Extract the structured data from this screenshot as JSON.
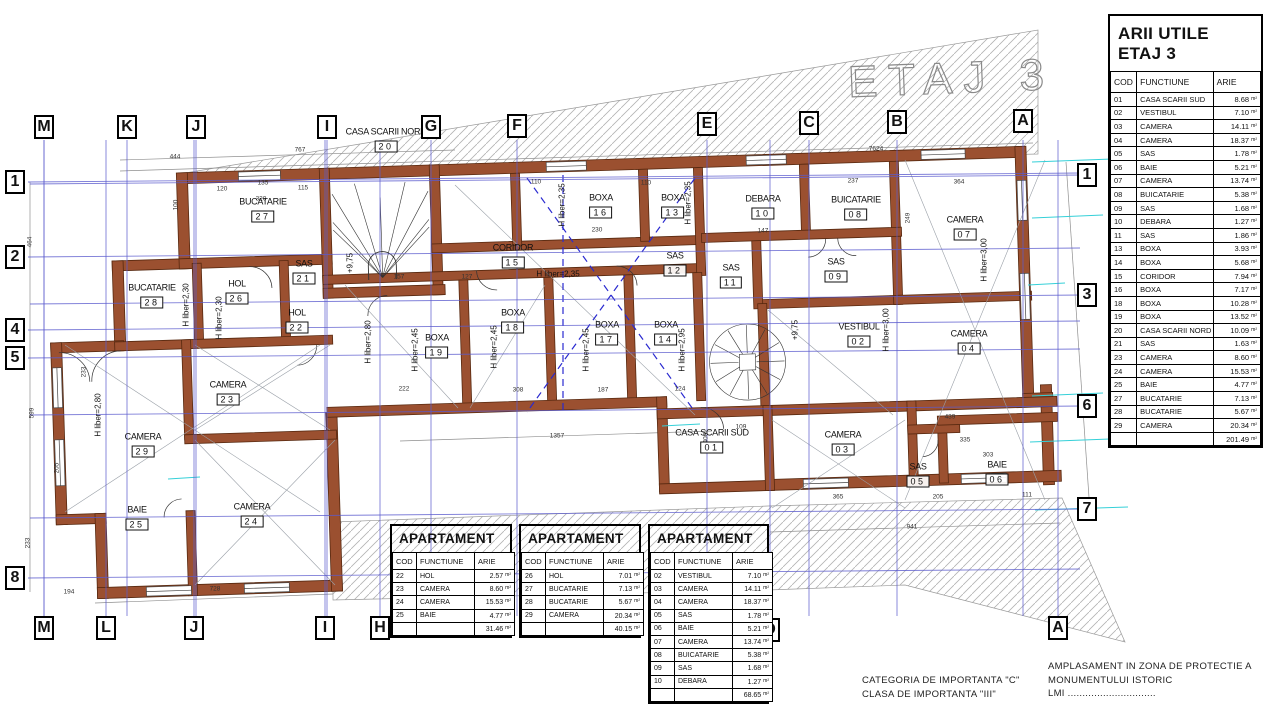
{
  "watermark": "ETAJ 3",
  "unit": "m²",
  "table_cols": [
    "COD",
    "FUNCTIUNE",
    "ARIE"
  ],
  "arii": {
    "title_line1": "ARII UTILE",
    "title_line2": "ETAJ 3",
    "rows": [
      [
        "01",
        "CASA SCARII SUD",
        "8.68"
      ],
      [
        "02",
        "VESTIBUL",
        "7.10"
      ],
      [
        "03",
        "CAMERA",
        "14.11"
      ],
      [
        "04",
        "CAMERA",
        "18.37"
      ],
      [
        "05",
        "SAS",
        "1.78"
      ],
      [
        "06",
        "BAIE",
        "5.21"
      ],
      [
        "07",
        "CAMERA",
        "13.74"
      ],
      [
        "08",
        "BUICATARIE",
        "5.38"
      ],
      [
        "09",
        "SAS",
        "1.68"
      ],
      [
        "10",
        "DEBARA",
        "1.27"
      ],
      [
        "11",
        "SAS",
        "1.86"
      ],
      [
        "13",
        "BOXA",
        "3.93"
      ],
      [
        "14",
        "BOXA",
        "5.68"
      ],
      [
        "15",
        "CORIDOR",
        "7.94"
      ],
      [
        "16",
        "BOXA",
        "7.17"
      ],
      [
        "18",
        "BOXA",
        "10.28"
      ],
      [
        "19",
        "BOXA",
        "13.52"
      ],
      [
        "20",
        "CASA SCARII NORD",
        "10.09"
      ],
      [
        "21",
        "SAS",
        "1.63"
      ],
      [
        "23",
        "CAMERA",
        "8.60"
      ],
      [
        "24",
        "CAMERA",
        "15.53"
      ],
      [
        "25",
        "BAIE",
        "4.77"
      ],
      [
        "27",
        "BUCATARIE",
        "7.13"
      ],
      [
        "28",
        "BUCATARIE",
        "5.67"
      ],
      [
        "29",
        "CAMERA",
        "20.34"
      ]
    ],
    "total": "201.49"
  },
  "apartments": [
    {
      "title_line1": "APARTAMENT",
      "title_line2": "NORD 1",
      "x": 390,
      "y": 524,
      "w": 122,
      "rows": [
        [
          "22",
          "HOL",
          "2.57"
        ],
        [
          "23",
          "CAMERA",
          "8.60"
        ],
        [
          "24",
          "CAMERA",
          "15.53"
        ],
        [
          "25",
          "BAIE",
          "4.77"
        ]
      ],
      "total": "31.46"
    },
    {
      "title_line1": "APARTAMENT",
      "title_line2": "NORD 2",
      "x": 519,
      "y": 524,
      "w": 122,
      "rows": [
        [
          "26",
          "HOL",
          "7.01"
        ],
        [
          "27",
          "BUCATARIE",
          "7.13"
        ],
        [
          "28",
          "BUCATARIE",
          "5.67"
        ],
        [
          "29",
          "CAMERA",
          "20.34"
        ]
      ],
      "total": "40.15"
    },
    {
      "title_line1": "APARTAMENT",
      "title_line2": "SUD",
      "x": 648,
      "y": 524,
      "w": 121,
      "rows": [
        [
          "02",
          "VESTIBUL",
          "7.10"
        ],
        [
          "03",
          "CAMERA",
          "14.11"
        ],
        [
          "04",
          "CAMERA",
          "18.37"
        ],
        [
          "05",
          "SAS",
          "1.78"
        ],
        [
          "06",
          "BAIE",
          "5.21"
        ],
        [
          "07",
          "CAMERA",
          "13.74"
        ],
        [
          "08",
          "BUICATARIE",
          "5.38"
        ],
        [
          "09",
          "SAS",
          "1.68"
        ],
        [
          "10",
          "DEBARA",
          "1.27"
        ]
      ],
      "total": "68.65"
    }
  ],
  "footer": {
    "categoria_line1": "CATEGORIA  DE  IMPORTANTA    \"C\"",
    "categoria_line2": "CLASA  DE  IMPORTANTA    \"III\"",
    "amplasament_line1": "AMPLASAMENT  IN  ZONA  DE  PROTECTIE  A",
    "amplasament_line2": "MONUMENTULUI  ISTORIC",
    "amplasament_line3": "LMI  .............................."
  },
  "axes": {
    "top": [
      {
        "l": "M",
        "x": 44,
        "y": 127
      },
      {
        "l": "K",
        "x": 127,
        "y": 127
      },
      {
        "l": "J",
        "x": 196,
        "y": 127
      },
      {
        "l": "I",
        "x": 327,
        "y": 127
      },
      {
        "l": "G",
        "x": 431,
        "y": 127
      },
      {
        "l": "F",
        "x": 517,
        "y": 126
      },
      {
        "l": "E",
        "x": 707,
        "y": 124
      },
      {
        "l": "C",
        "x": 809,
        "y": 123
      },
      {
        "l": "B",
        "x": 897,
        "y": 122
      },
      {
        "l": "A",
        "x": 1023,
        "y": 121
      }
    ],
    "bottom": [
      {
        "l": "M",
        "x": 44,
        "y": 628
      },
      {
        "l": "L",
        "x": 106,
        "y": 628
      },
      {
        "l": "J",
        "x": 194,
        "y": 628
      },
      {
        "l": "I",
        "x": 325,
        "y": 628
      },
      {
        "l": "H",
        "x": 380,
        "y": 628
      },
      {
        "l": "D",
        "x": 770,
        "y": 630
      },
      {
        "l": "A",
        "x": 1058,
        "y": 628
      }
    ],
    "left": [
      {
        "l": "1",
        "x": 15,
        "y": 182
      },
      {
        "l": "2",
        "x": 15,
        "y": 257
      },
      {
        "l": "4",
        "x": 15,
        "y": 330
      },
      {
        "l": "5",
        "x": 15,
        "y": 358
      },
      {
        "l": "8",
        "x": 15,
        "y": 578
      }
    ],
    "right": [
      {
        "l": "1",
        "x": 1087,
        "y": 175
      },
      {
        "l": "3",
        "x": 1087,
        "y": 295
      },
      {
        "l": "6",
        "x": 1087,
        "y": 406
      },
      {
        "l": "7",
        "x": 1087,
        "y": 509
      }
    ]
  },
  "rooms": [
    {
      "name": "CASA SCARII NORD",
      "code": "20",
      "x": 386,
      "y": 141
    },
    {
      "name": "BUCATARIE",
      "code": "27",
      "x": 263,
      "y": 211
    },
    {
      "name": "BUCATARIE",
      "code": "28",
      "x": 152,
      "y": 297
    },
    {
      "name": "HOL",
      "code": "26",
      "x": 237,
      "y": 293
    },
    {
      "name": "SAS",
      "code": "21",
      "x": 304,
      "y": 273
    },
    {
      "name": "HOL",
      "code": "22",
      "x": 297,
      "y": 322
    },
    {
      "name": "CAMERA",
      "code": "23",
      "x": 228,
      "y": 394
    },
    {
      "name": "CAMERA",
      "code": "29",
      "x": 143,
      "y": 446
    },
    {
      "name": "CAMERA",
      "code": "24",
      "x": 252,
      "y": 516
    },
    {
      "name": "BAIE",
      "code": "25",
      "x": 137,
      "y": 519
    },
    {
      "name": "BOXA",
      "code": "19",
      "x": 437,
      "y": 347
    },
    {
      "name": "BOXA",
      "code": "18",
      "x": 513,
      "y": 322
    },
    {
      "name": "BOXA",
      "code": "17",
      "x": 607,
      "y": 334
    },
    {
      "name": "BOXA",
      "code": "14",
      "x": 666,
      "y": 334
    },
    {
      "name": "CORIDOR",
      "code": "15",
      "x": 513,
      "y": 257
    },
    {
      "name": "BOXA",
      "code": "16",
      "x": 601,
      "y": 207
    },
    {
      "name": "BOXA",
      "code": "13",
      "x": 673,
      "y": 207
    },
    {
      "name": "SAS",
      "code": "12",
      "x": 675,
      "y": 265
    },
    {
      "name": "SAS",
      "code": "11",
      "x": 731,
      "y": 277
    },
    {
      "name": "DEBARA",
      "code": "10",
      "x": 763,
      "y": 208
    },
    {
      "name": "BUICATARIE",
      "code": "08",
      "x": 856,
      "y": 209
    },
    {
      "name": "SAS",
      "code": "09",
      "x": 836,
      "y": 271
    },
    {
      "name": "CAMERA",
      "code": "07",
      "x": 965,
      "y": 229
    },
    {
      "name": "VESTIBUL",
      "code": "02",
      "x": 859,
      "y": 336
    },
    {
      "name": "CAMERA",
      "code": "04",
      "x": 969,
      "y": 343
    },
    {
      "name": "CASA SCARII SUD",
      "code": "01",
      "x": 712,
      "y": 442
    },
    {
      "name": "CAMERA",
      "code": "03",
      "x": 843,
      "y": 444
    },
    {
      "name": "SAS",
      "code": "05",
      "x": 918,
      "y": 476
    },
    {
      "name": "BAIE",
      "code": "06",
      "x": 997,
      "y": 474
    }
  ],
  "annotations": [
    {
      "t": "H liber=2,30",
      "x": 186,
      "y": 305,
      "v": 1
    },
    {
      "t": "H liber=2,30",
      "x": 219,
      "y": 318,
      "v": 1
    },
    {
      "t": "H liber=2,80",
      "x": 98,
      "y": 415,
      "v": 1
    },
    {
      "t": "H liber=2,80",
      "x": 368,
      "y": 342,
      "v": 1
    },
    {
      "t": "H liber=2,45",
      "x": 415,
      "y": 350,
      "v": 1
    },
    {
      "t": "H liber=2,45",
      "x": 494,
      "y": 347,
      "v": 1
    },
    {
      "t": "H liber=2,45",
      "x": 586,
      "y": 350,
      "v": 1
    },
    {
      "t": "H liber=2,95",
      "x": 682,
      "y": 350,
      "v": 1
    },
    {
      "t": "H liber=2,35",
      "x": 558,
      "y": 274,
      "v": 0
    },
    {
      "t": "H liber=2,35",
      "x": 562,
      "y": 205,
      "v": 1
    },
    {
      "t": "H liber=2,35",
      "x": 688,
      "y": 203,
      "v": 1
    },
    {
      "t": "H liber=3,00",
      "x": 984,
      "y": 260,
      "v": 1
    },
    {
      "t": "H liber=3,00",
      "x": 886,
      "y": 330,
      "v": 1
    },
    {
      "t": "+9,75",
      "x": 350,
      "y": 263,
      "v": 1
    },
    {
      "t": "+9,75",
      "x": 795,
      "y": 330,
      "v": 1
    }
  ],
  "dims": [
    {
      "t": "444",
      "x": 175,
      "y": 157
    },
    {
      "t": "767",
      "x": 300,
      "y": 150
    },
    {
      "t": "7624",
      "x": 876,
      "y": 149
    },
    {
      "t": "120",
      "x": 222,
      "y": 189
    },
    {
      "t": "135",
      "x": 263,
      "y": 183
    },
    {
      "t": "115",
      "x": 303,
      "y": 188
    },
    {
      "t": "320",
      "x": 261,
      "y": 199
    },
    {
      "t": "100",
      "x": 176,
      "y": 205,
      "v": 1
    },
    {
      "t": "110",
      "x": 536,
      "y": 182
    },
    {
      "t": "110",
      "x": 646,
      "y": 183
    },
    {
      "t": "230",
      "x": 597,
      "y": 230
    },
    {
      "t": "147",
      "x": 763,
      "y": 231
    },
    {
      "t": "237",
      "x": 853,
      "y": 181
    },
    {
      "t": "364",
      "x": 959,
      "y": 182
    },
    {
      "t": "249",
      "x": 908,
      "y": 218,
      "v": 1
    },
    {
      "t": "157",
      "x": 399,
      "y": 277
    },
    {
      "t": "127",
      "x": 467,
      "y": 277
    },
    {
      "t": "222",
      "x": 404,
      "y": 389
    },
    {
      "t": "308",
      "x": 518,
      "y": 390
    },
    {
      "t": "187",
      "x": 603,
      "y": 390
    },
    {
      "t": "124",
      "x": 680,
      "y": 389
    },
    {
      "t": "1357",
      "x": 557,
      "y": 436
    },
    {
      "t": "941",
      "x": 912,
      "y": 527
    },
    {
      "t": "728",
      "x": 215,
      "y": 589
    },
    {
      "t": "194",
      "x": 69,
      "y": 592
    },
    {
      "t": "464",
      "x": 30,
      "y": 242,
      "v": 1
    },
    {
      "t": "599",
      "x": 32,
      "y": 413,
      "v": 1
    },
    {
      "t": "205",
      "x": 57,
      "y": 468,
      "v": 1
    },
    {
      "t": "233",
      "x": 28,
      "y": 543,
      "v": 1
    },
    {
      "t": "233",
      "x": 84,
      "y": 372,
      "v": 1
    },
    {
      "t": "365",
      "x": 838,
      "y": 497
    },
    {
      "t": "205",
      "x": 938,
      "y": 497
    },
    {
      "t": "111",
      "x": 1027,
      "y": 495
    },
    {
      "t": "303",
      "x": 988,
      "y": 455
    },
    {
      "t": "335",
      "x": 965,
      "y": 440
    },
    {
      "t": "439",
      "x": 950,
      "y": 417
    },
    {
      "t": "400",
      "x": 706,
      "y": 438,
      "v": 1
    },
    {
      "t": "109",
      "x": 741,
      "y": 427
    }
  ]
}
